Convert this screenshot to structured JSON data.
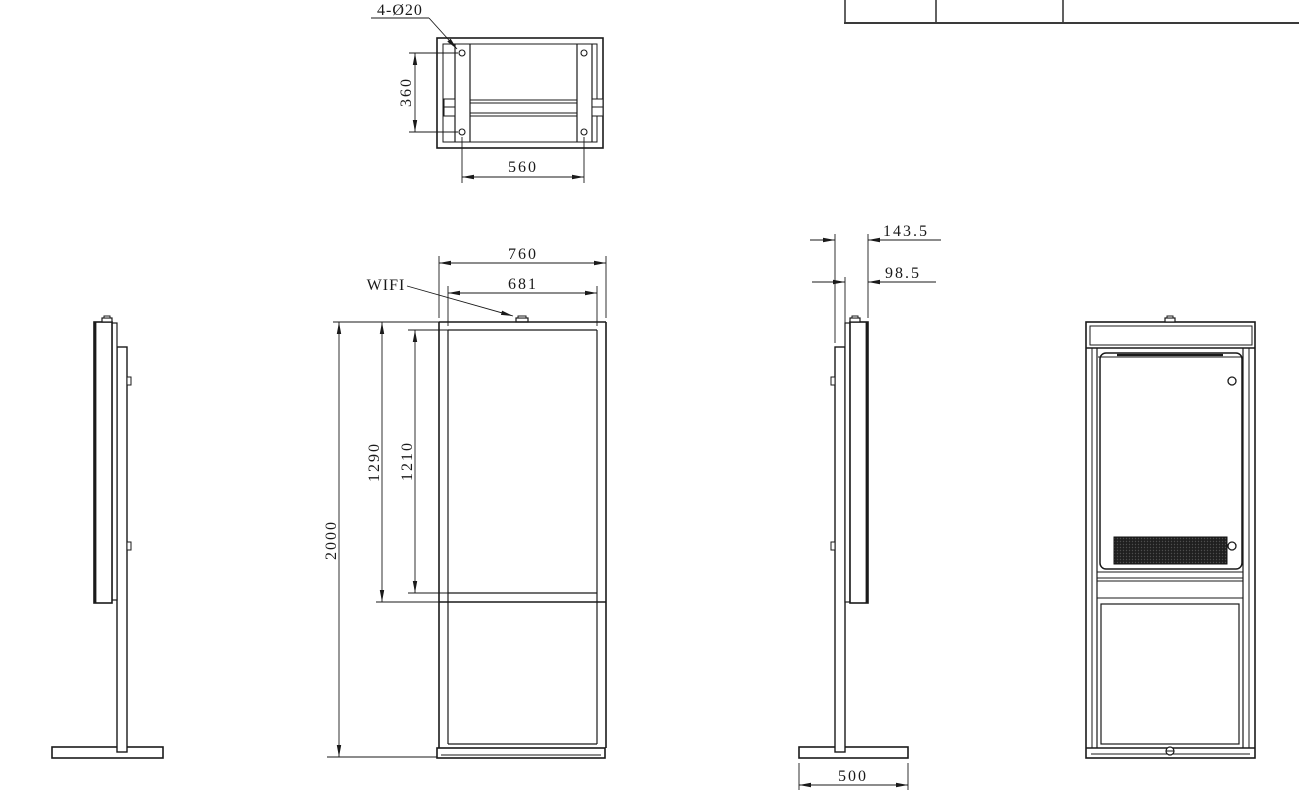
{
  "drawing": {
    "type": "engineering-drawing",
    "subject": "floor-standing digital signage kiosk",
    "units_implied": "mm",
    "colors": {
      "line": "#1a1a1a",
      "table_line": "#3a3a3a",
      "grille_fill": "#1f1f1f",
      "background": "#ffffff"
    }
  },
  "title_block": {
    "content": ""
  },
  "views": {
    "top_view": {
      "hole_callout": "4-Ø20",
      "dim_hole_spacing_vertical": "360",
      "dim_hole_spacing_horizontal": "560"
    },
    "front_view": {
      "antenna_label": "WIFI",
      "dim_overall_width": "760",
      "dim_screen_width": "681",
      "dim_overall_height": "2000",
      "dim_display_module_height": "1290",
      "dim_screen_height": "1210"
    },
    "side_view": {
      "dim_total_depth": "143.5",
      "dim_head_depth": "98.5",
      "dim_base_depth": "500"
    },
    "back_view": {
      "content": ""
    }
  }
}
